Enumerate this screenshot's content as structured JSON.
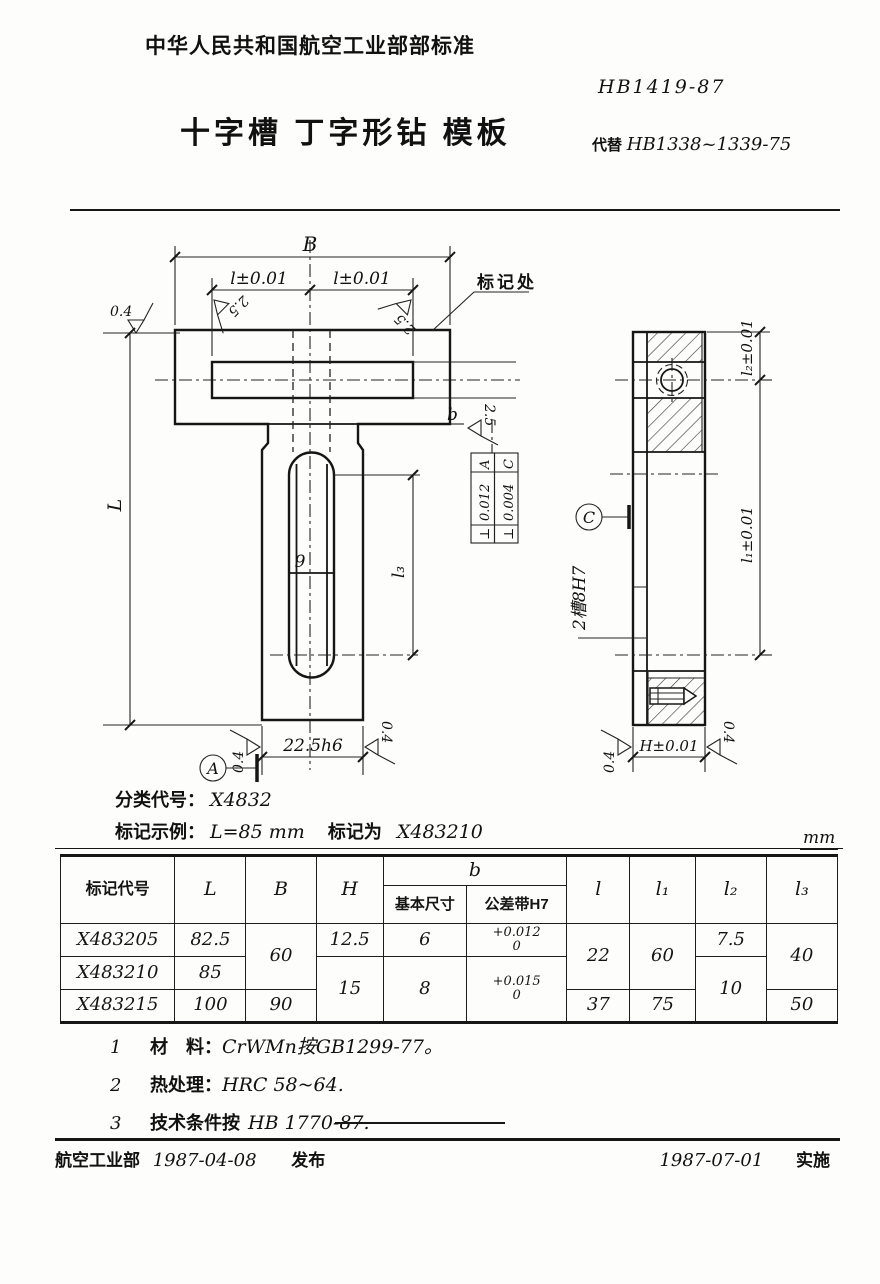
{
  "header": {
    "org_standard": "中华人民共和国航空工业部部标准",
    "standard_no": "HB1419-87",
    "title": "十字槽 丁字形钻 模板",
    "replaces_label": "代替",
    "replaces_no": "HB1338~1339-75"
  },
  "front_view": {
    "dim_B": "B",
    "dim_l_left": "l±0.01",
    "dim_l_right": "l±0.01",
    "mark_spot": "标记处",
    "finish_04": "0.4",
    "finish_25": "2.5",
    "dim_L": "L",
    "slot_width": "9",
    "dim_l3": "l₃",
    "slot_b": "b",
    "fcf1": {
      "symbol": "⊥",
      "tolerance": "0.012",
      "datum": "A"
    },
    "fcf2": {
      "symbol": "⊥",
      "tolerance": "0.004",
      "datum": "C"
    },
    "dim_bottom": "22.5h6",
    "datum_a": "A"
  },
  "side_view": {
    "dim_l2": "l₂±0.01",
    "dim_l1": "l₁±0.01",
    "datum_c": "C",
    "slot_callout": "2槽8H7",
    "dim_H": "H±0.01",
    "finish_04": "0.4"
  },
  "classification": {
    "class_label": "分类代号：",
    "class_code": "X4832",
    "example_label": "标记示例：",
    "example_condition": "L=85 mm",
    "example_mid": "标记为",
    "example_code": "X483210"
  },
  "unit_label": "mm",
  "table": {
    "headers": {
      "code": "标记代号",
      "L": "L",
      "B": "B",
      "H": "H",
      "b": "b",
      "b_basic": "基本尺寸",
      "b_tol": "公差带H7",
      "l": "l",
      "l1": "l₁",
      "l2": "l₂",
      "l3": "l₃"
    },
    "rows": {
      "r1": {
        "code": "X483205",
        "L": "82.5",
        "B": "60",
        "H": "12.5",
        "b_basic": "6",
        "tol_top": "+0.012",
        "tol_bottom": "0",
        "l": "22",
        "l1": "60",
        "l2": "7.5",
        "l3": "40"
      },
      "r2": {
        "code": "X483210",
        "L": "85",
        "H": "15",
        "b_basic": "8",
        "tol_top": "+0.015",
        "tol_bottom": "0",
        "l2": "10"
      },
      "r3": {
        "code": "X483215",
        "L": "100",
        "B": "90",
        "l": "37",
        "l1": "75",
        "l3": "50"
      }
    }
  },
  "notes": {
    "n1_num": "1",
    "n1_label": "材　料：",
    "n1_text": "CrWMn按GB1299-77。",
    "n2_num": "2",
    "n2_label": "热处理：",
    "n2_text": "HRC 58~64.",
    "n3_num": "3",
    "n3_label": "技术条件按",
    "n3_text": "HB 1770-87."
  },
  "footer": {
    "org": "航空工业部",
    "issue_date": "1987-04-08",
    "issue_label": "发布",
    "impl_date": "1987-07-01",
    "impl_label": "实施"
  }
}
